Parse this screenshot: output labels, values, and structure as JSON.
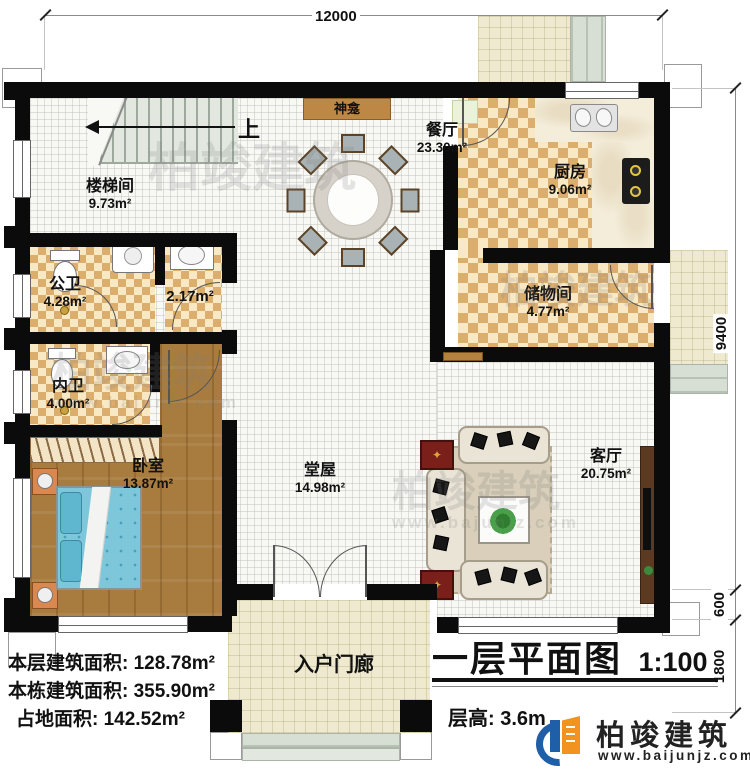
{
  "dimensions": {
    "top": "12000",
    "right_main": "9400",
    "right_step": "600",
    "right_porch": "1800"
  },
  "rooms": {
    "stairwell": {
      "name": "楼梯间",
      "area": "9.73m²"
    },
    "public_bath": {
      "name": "公卫",
      "area": "4.28m²"
    },
    "bath_vestibule": {
      "area": "2.17m²"
    },
    "inner_bath": {
      "name": "内卫",
      "area": "4.00m²"
    },
    "bedroom": {
      "name": "卧室",
      "area": "13.87m²"
    },
    "main_hall": {
      "name": "堂屋",
      "area": "14.98m²"
    },
    "dining": {
      "name": "餐厅",
      "area": "23.30m²"
    },
    "kitchen": {
      "name": "厨房",
      "area": "9.06m²"
    },
    "storage": {
      "name": "储物间",
      "area": "4.77m²"
    },
    "living": {
      "name": "客厅",
      "area": "20.75m²"
    },
    "entry_porch": {
      "name": "入户门廊"
    },
    "shrine": {
      "name": "神龛"
    }
  },
  "stairs": {
    "up_label": "上"
  },
  "stats": [
    {
      "label": "本层建筑面积:",
      "value": "128.78m²"
    },
    {
      "label": "本栋建筑面积:",
      "value": "355.90m²"
    },
    {
      "label": "占地面积:",
      "value": "142.52m²"
    }
  ],
  "title_block": {
    "title": "一层平面图",
    "scale": "1:100",
    "floor_height_label": "层高:",
    "floor_height_value": "3.6m"
  },
  "brand": {
    "name": "柏竣建筑",
    "website": "www.baijunjz.com"
  },
  "watermark": {
    "name": "柏竣建筑",
    "website": "www.bajunjz.com"
  },
  "colors": {
    "wall": "#0b0b0b",
    "checker_dark": "#dcae6e",
    "checker_light": "#f8e8c3",
    "wood": "#a87c3e",
    "bed_blue": "#7ec7db",
    "accent_red": "#7a1f1a",
    "brand_blue": "#1f5fa8",
    "brand_orange": "#f0931f"
  }
}
